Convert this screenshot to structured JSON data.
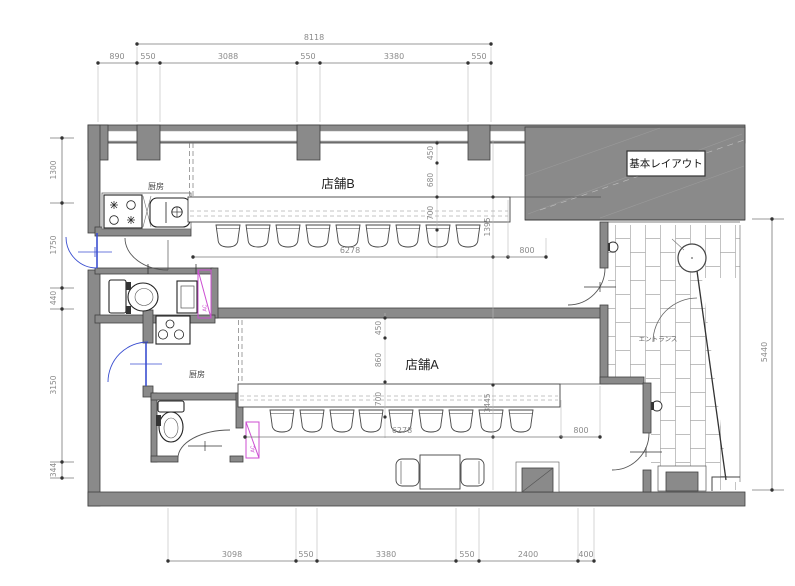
{
  "title_block": {
    "label": "基本レイアウト"
  },
  "rooms": {
    "store_b": "店舗B",
    "store_a": "店舗A",
    "kitchen_b": "厨房",
    "kitchen_a": "厨房",
    "entrance": "エントランス"
  },
  "equipment": {
    "ac_b": "AC",
    "ac_a": "AC"
  },
  "dimensions": {
    "top": {
      "overall": "8118",
      "segments": [
        "890",
        "550",
        "3088",
        "550",
        "3380",
        "550"
      ]
    },
    "left": {
      "segments": [
        "1300",
        "1750",
        "440",
        "3150",
        "344"
      ]
    },
    "bottom": {
      "segments": [
        "3098",
        "550",
        "3380",
        "550",
        "2400",
        "400"
      ]
    },
    "right": {
      "overall": "5440"
    },
    "store_b": {
      "offset_top": "450",
      "counter_depth": "680",
      "stool_zone": "700",
      "side": "1395",
      "counter_length": "6278",
      "door_side": "800"
    },
    "store_a": {
      "offset_top": "450",
      "counter_depth": "860",
      "stool_zone": "700",
      "side": "3445",
      "counter_length": "6278",
      "door_side": "800"
    }
  },
  "colors": {
    "wall": "#8a8a8a",
    "door": "#3b4fd0",
    "ac_unit": "#cc4ed2",
    "dim_text": "#8a8a8a",
    "tile_joint": "#aaaaaa"
  }
}
